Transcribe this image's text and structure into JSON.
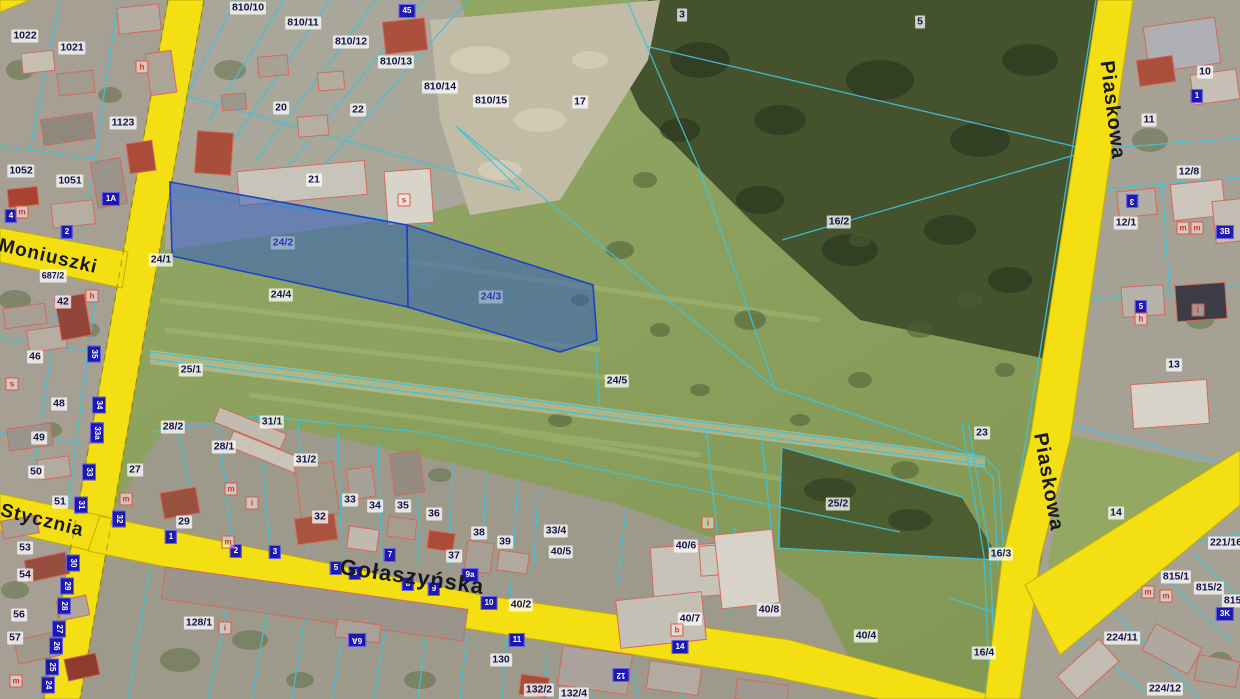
{
  "map": {
    "colors": {
      "road": "#f4df12",
      "road_edge": "#c3ae09",
      "parcel_line": "#3fc3da",
      "highlight_fill": "#2e5cc5",
      "highlight_edge": "#1b43c8",
      "address_marker_bg": "#1d18b0",
      "letter_marker_red": "#d83225",
      "label_text": "#131347"
    },
    "streets": [
      {
        "label": "Moniuszki",
        "x": 48,
        "y": 257,
        "rot": 13,
        "size": 19
      },
      {
        "label": "Stycznia",
        "x": 42,
        "y": 521,
        "rot": 14,
        "size": 19
      },
      {
        "label": "Gołaszyńska",
        "x": 412,
        "y": 577,
        "rot": 8,
        "size": 22
      },
      {
        "label": "Piaskowa",
        "x": 1112,
        "y": 110,
        "rot": 83,
        "size": 20
      },
      {
        "label": "Piaskowa",
        "x": 1048,
        "y": 482,
        "rot": 80,
        "size": 20
      }
    ],
    "highlight_labels": [
      {
        "label": "24/2",
        "x": 283,
        "y": 243
      },
      {
        "label": "24/3",
        "x": 491,
        "y": 297
      }
    ],
    "parcel_labels": [
      {
        "label": "1022",
        "x": 25,
        "y": 36
      },
      {
        "label": "1021",
        "x": 72,
        "y": 48
      },
      {
        "label": "1123",
        "x": 123,
        "y": 123
      },
      {
        "label": "1052",
        "x": 21,
        "y": 171
      },
      {
        "label": "1051",
        "x": 70,
        "y": 181
      },
      {
        "label": "810/10",
        "x": 248,
        "y": 8
      },
      {
        "label": "810/11",
        "x": 303,
        "y": 23
      },
      {
        "label": "810/12",
        "x": 351,
        "y": 42
      },
      {
        "label": "810/13",
        "x": 396,
        "y": 62
      },
      {
        "label": "810/14",
        "x": 440,
        "y": 87
      },
      {
        "label": "810/15",
        "x": 491,
        "y": 101
      },
      {
        "label": "20",
        "x": 281,
        "y": 108
      },
      {
        "label": "22",
        "x": 358,
        "y": 110
      },
      {
        "label": "21",
        "x": 314,
        "y": 180
      },
      {
        "label": "17",
        "x": 580,
        "y": 102
      },
      {
        "label": "3",
        "x": 682,
        "y": 15
      },
      {
        "label": "5",
        "x": 920,
        "y": 22
      },
      {
        "label": "10",
        "x": 1205,
        "y": 72
      },
      {
        "label": "11",
        "x": 1149,
        "y": 120
      },
      {
        "label": "12/8",
        "x": 1189,
        "y": 172
      },
      {
        "label": "12/1",
        "x": 1126,
        "y": 223
      },
      {
        "label": "13",
        "x": 1174,
        "y": 365
      },
      {
        "label": "16/2",
        "x": 839,
        "y": 222
      },
      {
        "label": "24/1",
        "x": 161,
        "y": 260
      },
      {
        "label": "687/2",
        "x": 53,
        "y": 276,
        "size": 9
      },
      {
        "label": "24/4",
        "x": 281,
        "y": 295
      },
      {
        "label": "25/1",
        "x": 191,
        "y": 370
      },
      {
        "label": "24/5",
        "x": 617,
        "y": 381
      },
      {
        "label": "23",
        "x": 982,
        "y": 433
      },
      {
        "label": "25/2",
        "x": 838,
        "y": 504
      },
      {
        "label": "16/3",
        "x": 1001,
        "y": 554
      },
      {
        "label": "40/4",
        "x": 866,
        "y": 636
      },
      {
        "label": "16/4",
        "x": 984,
        "y": 653
      },
      {
        "label": "14",
        "x": 1116,
        "y": 513
      },
      {
        "label": "221/16",
        "x": 1226,
        "y": 543
      },
      {
        "label": "815/1",
        "x": 1176,
        "y": 577
      },
      {
        "label": "815/2",
        "x": 1209,
        "y": 588
      },
      {
        "label": "815/3",
        "x": 1237,
        "y": 601
      },
      {
        "label": "224/11",
        "x": 1122,
        "y": 638
      },
      {
        "label": "224/12",
        "x": 1165,
        "y": 689
      },
      {
        "label": "42",
        "x": 63,
        "y": 302
      },
      {
        "label": "46",
        "x": 35,
        "y": 357
      },
      {
        "label": "48",
        "x": 59,
        "y": 404
      },
      {
        "label": "49",
        "x": 39,
        "y": 438
      },
      {
        "label": "50",
        "x": 36,
        "y": 472
      },
      {
        "label": "51",
        "x": 60,
        "y": 502
      },
      {
        "label": "53",
        "x": 25,
        "y": 548
      },
      {
        "label": "54",
        "x": 25,
        "y": 575
      },
      {
        "label": "56",
        "x": 19,
        "y": 615
      },
      {
        "label": "57",
        "x": 15,
        "y": 638
      },
      {
        "label": "27",
        "x": 135,
        "y": 470
      },
      {
        "label": "28/2",
        "x": 173,
        "y": 427
      },
      {
        "label": "28/1",
        "x": 224,
        "y": 447
      },
      {
        "label": "31/1",
        "x": 272,
        "y": 422
      },
      {
        "label": "31/2",
        "x": 306,
        "y": 460
      },
      {
        "label": "29",
        "x": 184,
        "y": 522
      },
      {
        "label": "32",
        "x": 320,
        "y": 517
      },
      {
        "label": "33",
        "x": 350,
        "y": 500
      },
      {
        "label": "34",
        "x": 375,
        "y": 506
      },
      {
        "label": "35",
        "x": 403,
        "y": 506
      },
      {
        "label": "36",
        "x": 434,
        "y": 514
      },
      {
        "label": "37",
        "x": 454,
        "y": 556
      },
      {
        "label": "38",
        "x": 479,
        "y": 533
      },
      {
        "label": "39",
        "x": 505,
        "y": 542
      },
      {
        "label": "33/4",
        "x": 556,
        "y": 531
      },
      {
        "label": "40/5",
        "x": 561,
        "y": 552
      },
      {
        "label": "40/6",
        "x": 686,
        "y": 546
      },
      {
        "label": "40/2",
        "x": 521,
        "y": 605
      },
      {
        "label": "40/7",
        "x": 690,
        "y": 619
      },
      {
        "label": "40/8",
        "x": 769,
        "y": 610
      },
      {
        "label": "128/1",
        "x": 199,
        "y": 623
      },
      {
        "label": "130",
        "x": 501,
        "y": 660
      },
      {
        "label": "132/2",
        "x": 539,
        "y": 690
      },
      {
        "label": "132/4",
        "x": 574,
        "y": 694
      }
    ],
    "address_markers": [
      {
        "label": "45",
        "x": 407,
        "y": 11
      },
      {
        "label": "2",
        "x": 67,
        "y": 232
      },
      {
        "label": "4",
        "x": 11,
        "y": 216
      },
      {
        "label": "1A",
        "x": 111,
        "y": 199
      },
      {
        "label": "35",
        "x": 94,
        "y": 354,
        "rot": 90
      },
      {
        "label": "34",
        "x": 99,
        "y": 405,
        "rot": 90
      },
      {
        "label": "33a",
        "x": 97,
        "y": 433,
        "rot": 90
      },
      {
        "label": "33",
        "x": 89,
        "y": 472,
        "rot": 90
      },
      {
        "label": "31",
        "x": 81,
        "y": 505,
        "rot": 90
      },
      {
        "label": "32",
        "x": 119,
        "y": 519,
        "rot": 90
      },
      {
        "label": "30",
        "x": 73,
        "y": 563,
        "rot": 90
      },
      {
        "label": "29",
        "x": 67,
        "y": 586,
        "rot": 90
      },
      {
        "label": "28",
        "x": 64,
        "y": 606,
        "rot": 90
      },
      {
        "label": "27",
        "x": 59,
        "y": 629,
        "rot": 90
      },
      {
        "label": "26",
        "x": 56,
        "y": 646,
        "rot": 90
      },
      {
        "label": "25",
        "x": 52,
        "y": 667,
        "rot": 90
      },
      {
        "label": "24",
        "x": 48,
        "y": 685,
        "rot": 90
      },
      {
        "label": "1",
        "x": 171,
        "y": 537
      },
      {
        "label": "2",
        "x": 236,
        "y": 551
      },
      {
        "label": "3",
        "x": 275,
        "y": 552
      },
      {
        "label": "5",
        "x": 336,
        "y": 568
      },
      {
        "label": "6",
        "x": 355,
        "y": 573
      },
      {
        "label": "7",
        "x": 390,
        "y": 555
      },
      {
        "label": "8",
        "x": 408,
        "y": 584
      },
      {
        "label": "9",
        "x": 434,
        "y": 589
      },
      {
        "label": "9a",
        "x": 470,
        "y": 575
      },
      {
        "label": "10",
        "x": 489,
        "y": 603
      },
      {
        "label": "11",
        "x": 517,
        "y": 640
      },
      {
        "label": "12",
        "x": 621,
        "y": 675,
        "rot": 180
      },
      {
        "label": "14",
        "x": 680,
        "y": 647
      },
      {
        "label": "6A",
        "x": 357,
        "y": 640,
        "rot": 180
      },
      {
        "label": "3",
        "x": 1132,
        "y": 201,
        "rot": 180
      },
      {
        "label": "3B",
        "x": 1225,
        "y": 232
      },
      {
        "label": "1",
        "x": 1197,
        "y": 96
      },
      {
        "label": "5",
        "x": 1141,
        "y": 307
      },
      {
        "label": "3K",
        "x": 1225,
        "y": 614
      }
    ],
    "letter_markers": [
      {
        "label": "h",
        "x": 142,
        "y": 67
      },
      {
        "label": "m",
        "x": 22,
        "y": 212
      },
      {
        "label": "h",
        "x": 92,
        "y": 296
      },
      {
        "label": "s",
        "x": 12,
        "y": 384
      },
      {
        "label": "s",
        "x": 404,
        "y": 200
      },
      {
        "label": "m",
        "x": 231,
        "y": 489
      },
      {
        "label": "m",
        "x": 126,
        "y": 499
      },
      {
        "label": "m",
        "x": 228,
        "y": 542
      },
      {
        "label": "i",
        "x": 252,
        "y": 503
      },
      {
        "label": "i",
        "x": 225,
        "y": 628
      },
      {
        "label": "m",
        "x": 16,
        "y": 681
      },
      {
        "label": "b",
        "x": 677,
        "y": 630
      },
      {
        "label": "i",
        "x": 708,
        "y": 523
      },
      {
        "label": "m",
        "x": 1183,
        "y": 228
      },
      {
        "label": "m",
        "x": 1197,
        "y": 228
      },
      {
        "label": "h",
        "x": 1141,
        "y": 319
      },
      {
        "label": "i",
        "x": 1198,
        "y": 310
      },
      {
        "label": "m",
        "x": 1148,
        "y": 592
      },
      {
        "label": "m",
        "x": 1166,
        "y": 596
      }
    ]
  }
}
